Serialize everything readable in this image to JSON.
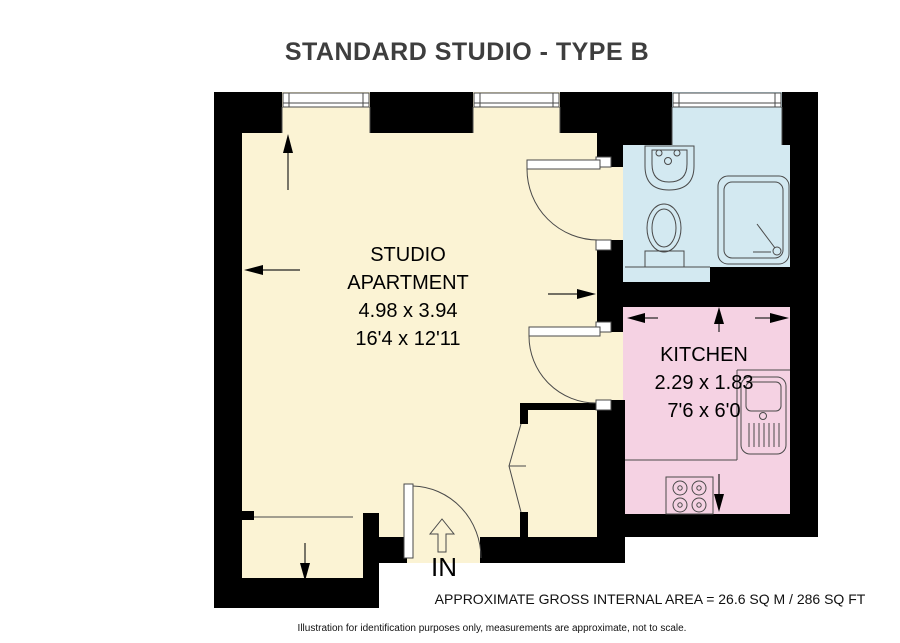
{
  "title": {
    "text": "STANDARD STUDIO - TYPE B"
  },
  "plan": {
    "wall_color": "#000000",
    "line_color": "#4a4a4a",
    "studio": {
      "label_line1": "STUDIO",
      "label_line2": "APARTMENT",
      "dimensions_metric": "4.98 x 3.94",
      "dimensions_imperial": "16'4 x 12'11",
      "floor_color": "#FBF3D4"
    },
    "kitchen": {
      "label": "KITCHEN",
      "dimensions_metric": "2.29 x 1.83",
      "dimensions_imperial": "7'6 x 6'0",
      "floor_color": "#F5D2E3"
    },
    "bathroom": {
      "floor_color": "#D3E9F1"
    },
    "entrance": {
      "label": "IN"
    }
  },
  "footer": {
    "area_text": "APPROXIMATE GROSS INTERNAL AREA = 26.6 SQ M / 286 SQ FT",
    "disclaimer": "Illustration for identification purposes only, measurements are approximate, not to scale."
  }
}
